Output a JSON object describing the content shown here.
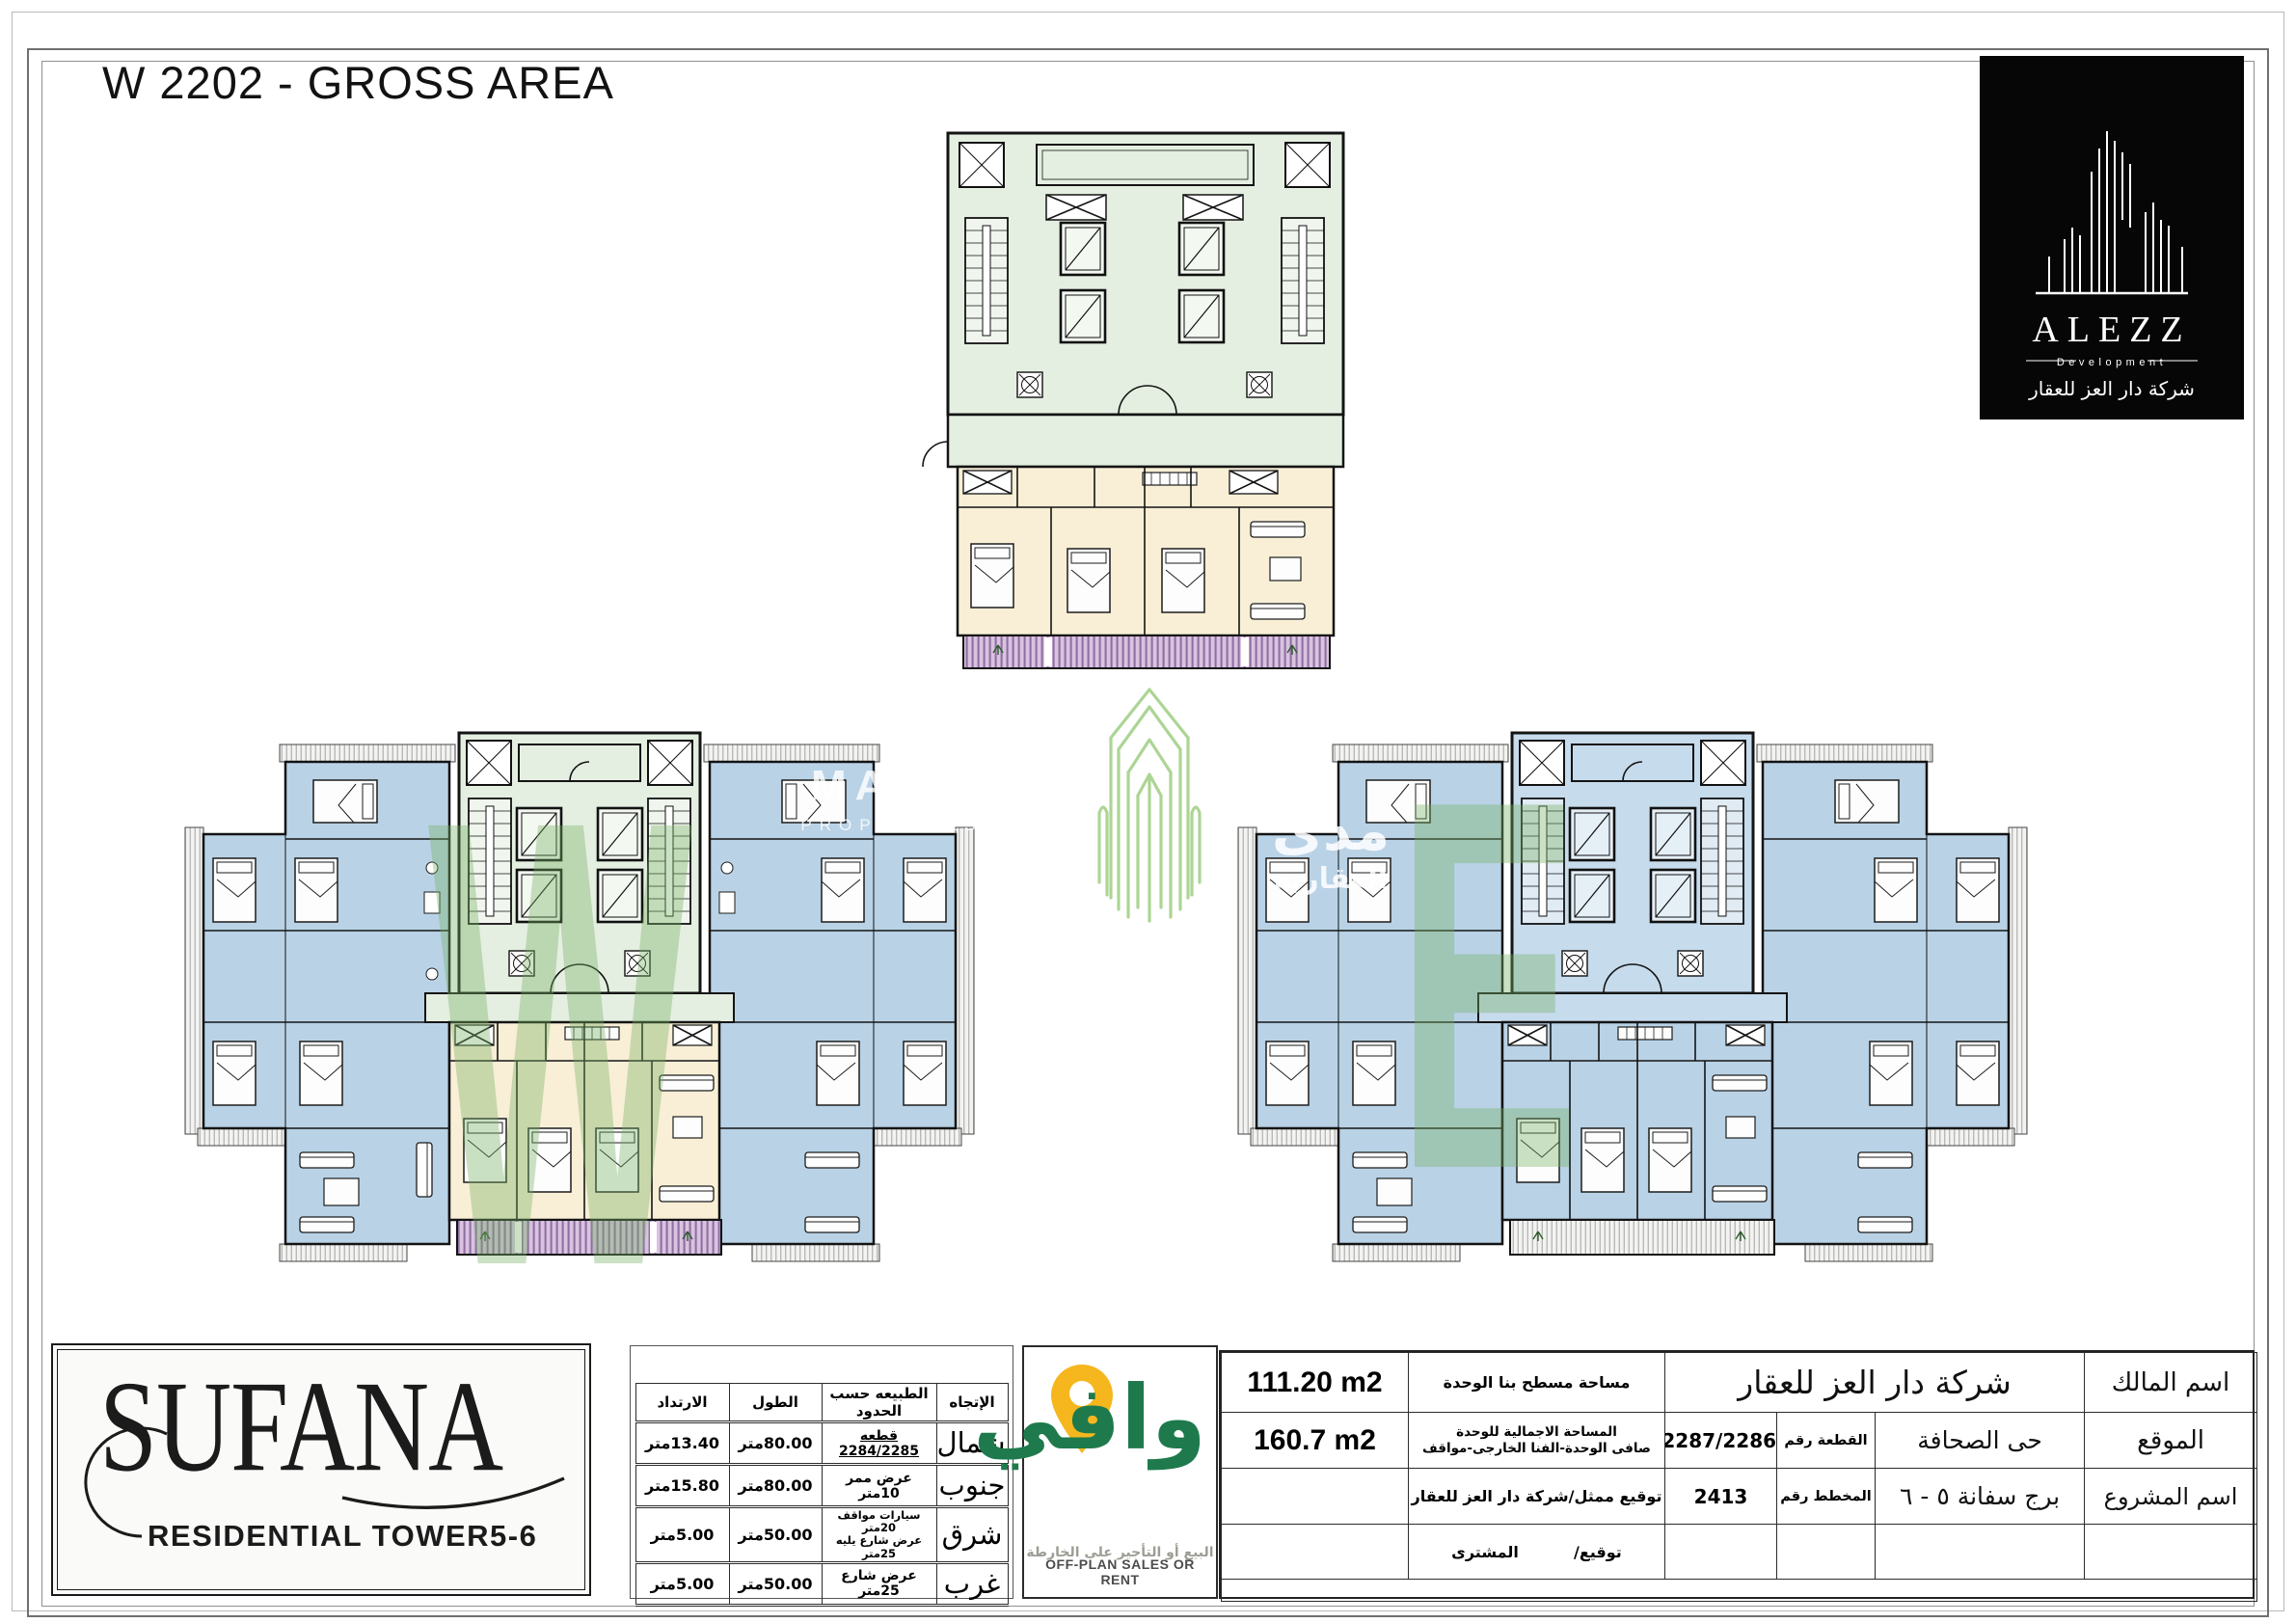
{
  "page": {
    "title": "W 2202 - GROSS AREA"
  },
  "logos": {
    "alezz": {
      "name": "ALEZZ",
      "subtitle": "Development",
      "company_ar": "شركة دار العز للعقار"
    },
    "sufana": {
      "name": "SUFANA",
      "subtitle": "RESIDENTIAL TOWER",
      "towers": "5-6"
    },
    "wafi": {
      "name_ar": "وافي",
      "tagline_ar": "البيع أو التأجير على الخارطة",
      "tagline_en": "OFF-PLAN SALES OR RENT"
    }
  },
  "watermarks": {
    "left_plan_letter": "W",
    "right_plan_letter": "E",
    "mada_line1": "MADA",
    "mada_line2": "PROPERTIES",
    "mada_ar_line1": "مدى",
    "mada_ar_line2": "العقارية"
  },
  "boundaries_table": {
    "headers": {
      "direction": "الإتجاه",
      "nature": "الطبيعه حسب الحدود",
      "length": "الطول",
      "setback": "الارتداد"
    },
    "rows": [
      {
        "direction": "شمال",
        "nature": "قطعه 2284/2285",
        "length": "80.00متر",
        "setback": "13.40متر"
      },
      {
        "direction": "جنوب",
        "nature": "عرض ممر 10متر",
        "length": "80.00متر",
        "setback": "15.80متر"
      },
      {
        "direction": "شرق",
        "nature": "سيارات مواقف 20متر",
        "nature_line2": "عرض شارع يليه 25متر",
        "length": "50.00متر",
        "setback": "5.00متر"
      },
      {
        "direction": "غرب",
        "nature": "عرض شارع 25متر",
        "length": "50.00متر",
        "setback": "5.00متر"
      }
    ]
  },
  "info_table": {
    "owner_label": "اسم المالك",
    "owner_value": "شركة دار العز للعقار",
    "location_label": "الموقع",
    "location_value": "حى الصحافة",
    "project_label": "اسم المشروع",
    "project_value": "برج سفانة ٥ - ٦",
    "plot_label": "القطعة رقم",
    "plot_value": "2287/2286",
    "plan_label": "المخطط رقم",
    "plan_value": "2413",
    "builtup_area_label": "مساحة مسطح بنا الوحدة",
    "builtup_area_value": "111.20 m2",
    "total_area_label_line1": "المساحة الاجمالية للوحدة",
    "total_area_label_line2": "صافى الوحدة-الفنا الخارجى-مواقف",
    "total_area_value": "160.7 m2",
    "rep_signature_label": "توقيع ممثل/شركة دار العز للعقار",
    "buyer_signature_prefix": "توقيع/",
    "buyer_signature_value": "المشترى"
  },
  "colors": {
    "core_green": "#e4efe1",
    "unit_blue": "#b9d2e6",
    "unit_cream": "#f8efd6",
    "balcony_purple": "#d9c3e0",
    "watermark_green": "#76b163",
    "wafi_green": "#1e7a4c",
    "wafi_pin_yellow": "#f6b71e",
    "mada_logo_green": "#a6d28c",
    "logo_black": "#060606"
  }
}
